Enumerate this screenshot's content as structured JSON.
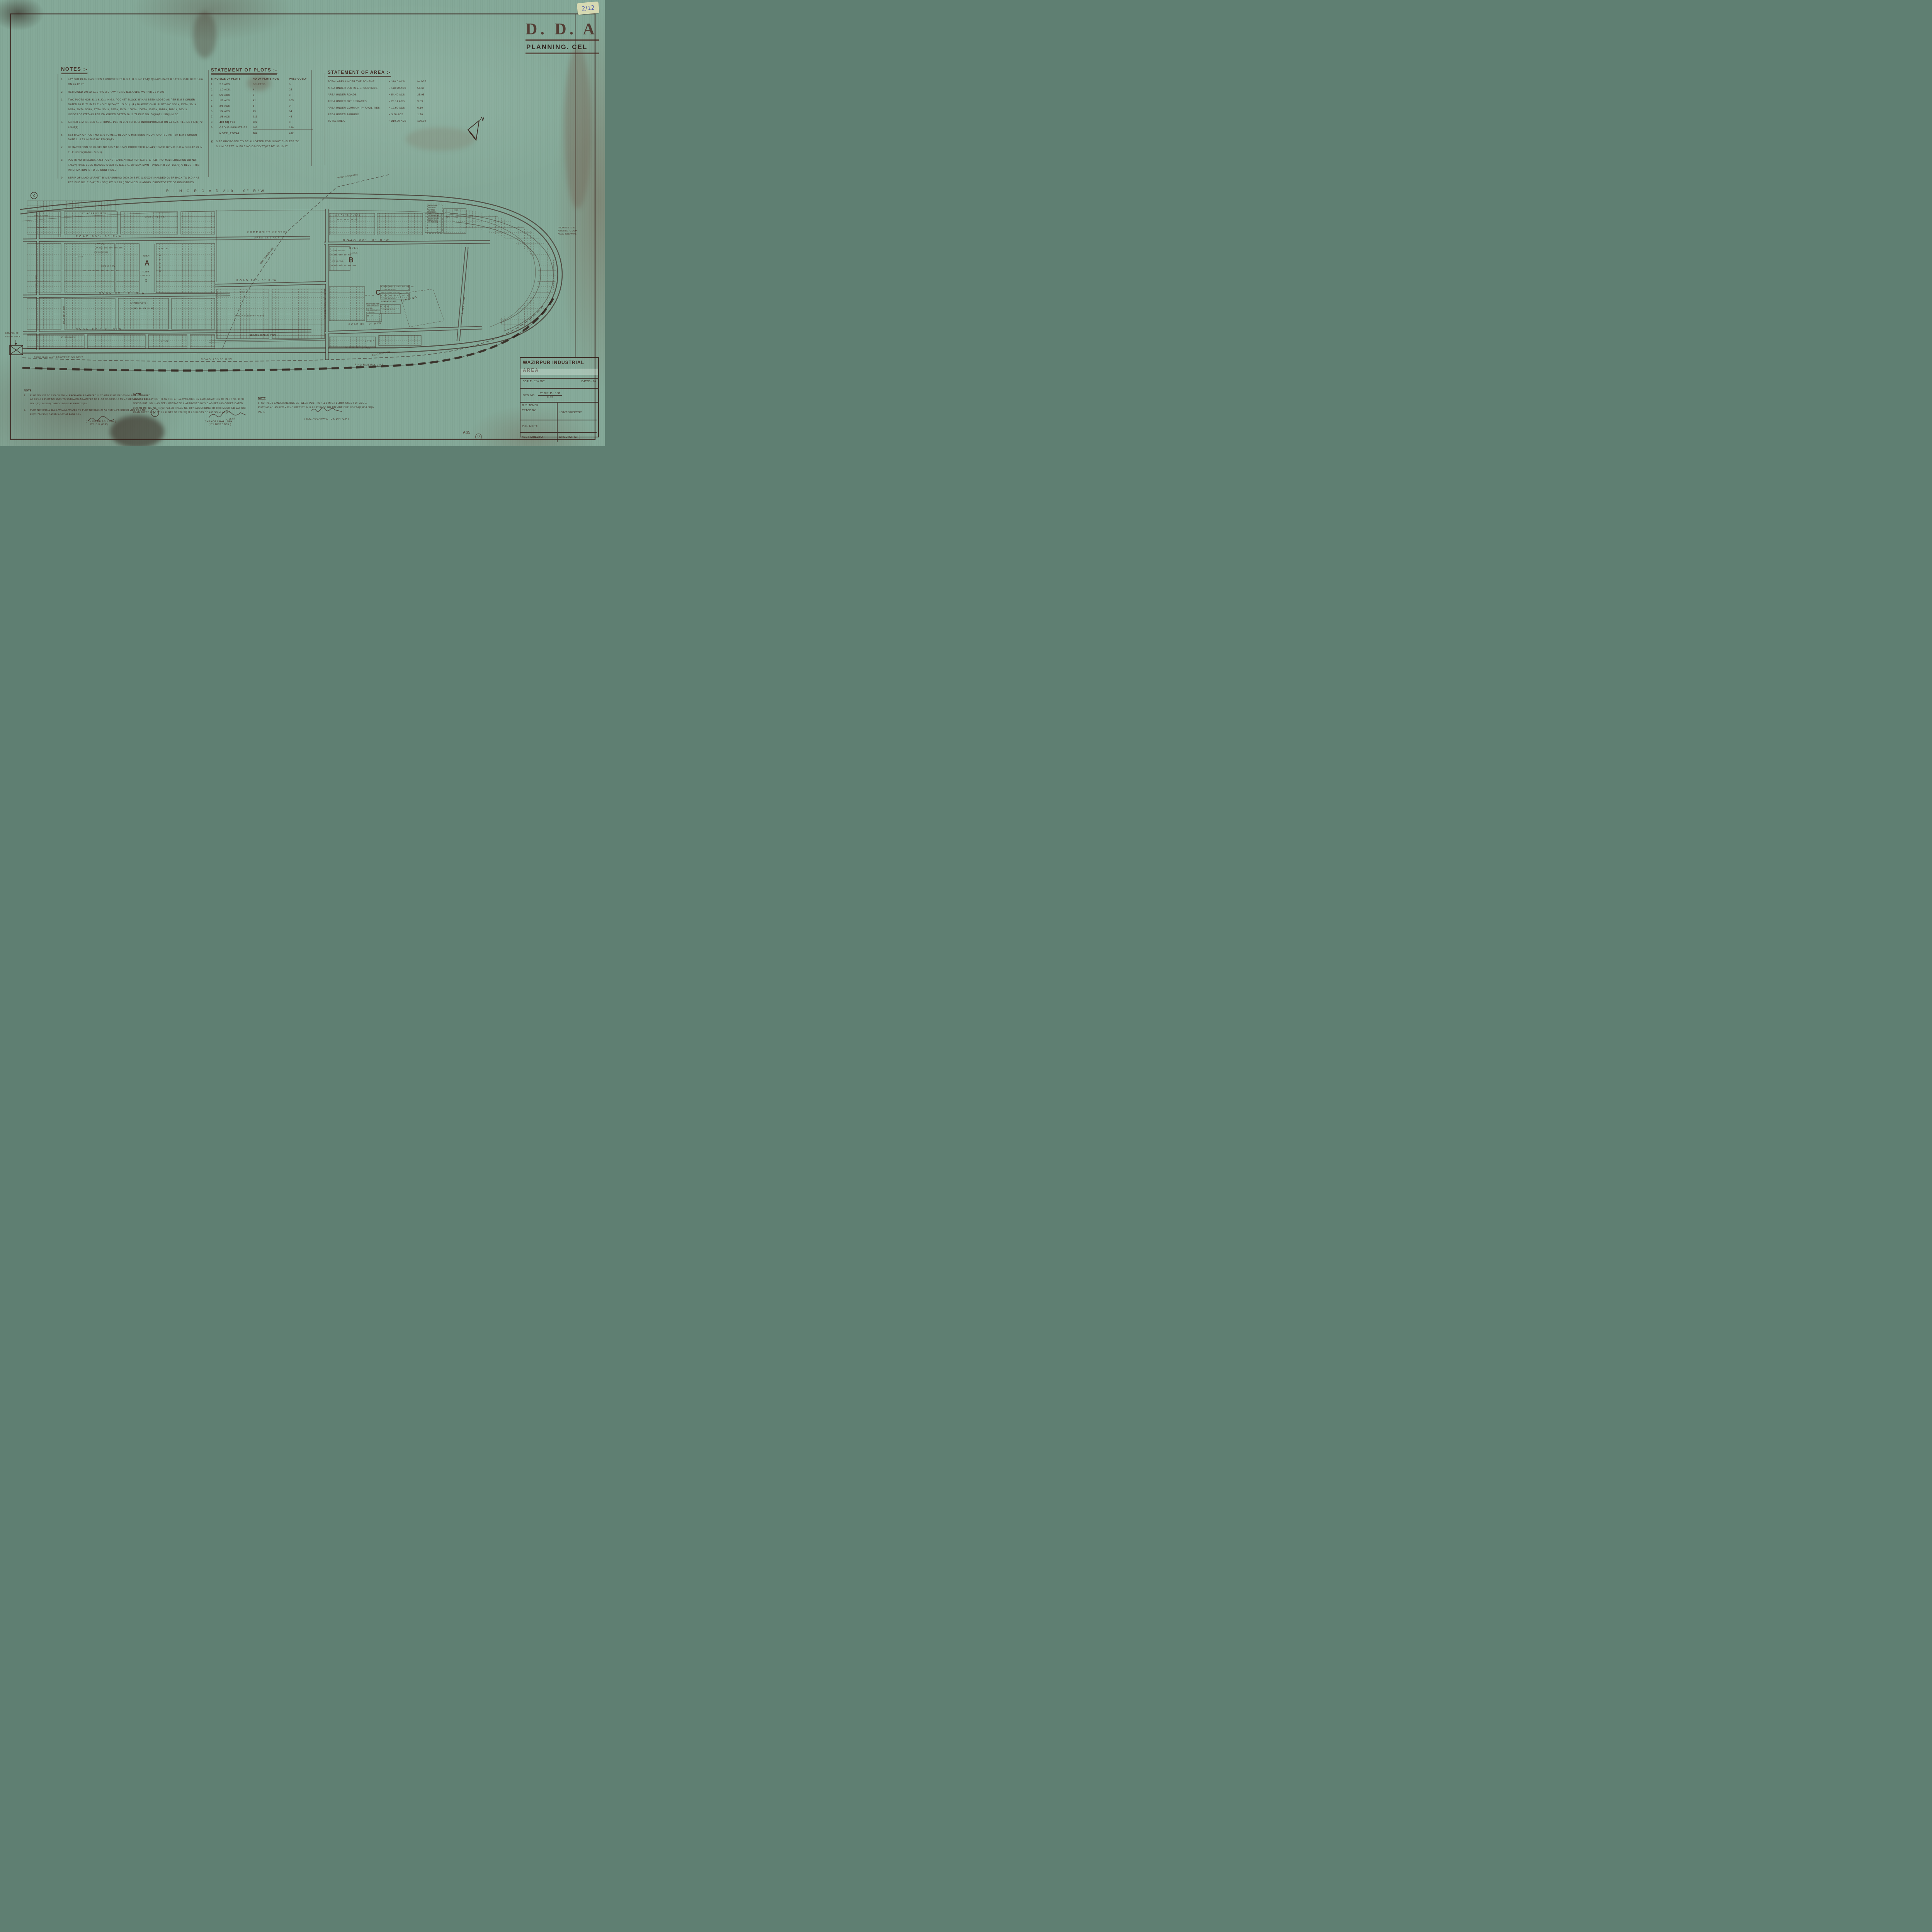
{
  "stamp": {
    "org": "D. D. A",
    "dept": "PLANNING. CEL"
  },
  "sticker": {
    "ref": "2/12"
  },
  "annotations": {
    "sheet_no": "605",
    "corner_mark": "B"
  },
  "notes": {
    "title": "NOTES :-",
    "items": [
      {
        "no": "1.",
        "text": "LAY OUT PLAN HAS BEEN APPROVED BY D.D.A, U.D. NO F14(32)61-WD PART II DATED 15TH DEC, 1967 ON 26.12.67."
      },
      {
        "no": "2",
        "text": "RETRACED ON 22.6.71 FROM DRAWING NO D.D.A/1167  WZRP(I)-7 / P-508"
      },
      {
        "no": "3.",
        "text": "TWO PLOTS NOS 31/1 & 32/1 IN G.I. POCKET BLOCK 'B' HAS BEEN ADDED AS PER E.M'S ORDER DATED 20.11.71 IN FILE NO F12(204)67 L.S.B(1). (4.) 16 ADDITIONAL PLOTS NO 95/1a, 95/2a, 96/1a, 96/2a, 96/7a, 96/8a, 97/1a, 98/1a, 99/1a, 99/2a, 100/1a, 100/2a, 101/1a, 101/8a, 102/1a, 103/1a INCORPORATED AS PER EM ORDER DATED 26.12.71 FILE NO. F6(40)71 LSB(I) MISC."
      },
      {
        "no": "5.",
        "text": "AS PER E.M. ORDER ADDITIONAL PLOTS 91/1 TO 91/10 INCORPORATED ON 24.7.72. FILE NO F6(33)72 L.S.B(1)"
      },
      {
        "no": "6.",
        "text": "SET BACK OF PLOT NO 91/1 TO 91/10 BLOCK-C HAS BEEN INCORPORATED AS PER E.M'S ORDER DATE 11.9.73 IN FILE NO F29(45)73."
      },
      {
        "no": "7.",
        "text": "DEMARCATION OF PLOTS NO 103/7 TO 104/9 CORRECTED AS APPROVED BY V.C. D.D.A ON 8.12.73 IN FILE NO F6(90)70 L.S.B(1)."
      },
      {
        "no": "8.",
        "text": "PLOTS NO 28 BLOCK-A G.I POCKET EARMARKED FOR E.S.S. & PLOT NO. 90/2 (LOCATION DO NOT TALLY) HAVE BEEN HANDED OVER TO D.E.S.U. BY DEV. DIVN II (VIDE P-II CO F29(77)75 BLDG. THIS INFORMATION IS TO BE CONFIRMED"
      },
      {
        "no": "9",
        "text": "STRIP OF LAND MARKET 'B' MEASURING 2600.00 S.FT. (130'X20') HANDED OVER BACK TO D.D.A AS PER FILE NO. F15(41)72-LSB(I) DT. 3.6.78 ( FROM DELHI ADMIS. DIRECTORATE OF INDUSTRIES."
      }
    ]
  },
  "statement_of_plots": {
    "title": "STATEMENT OF PLOTS :-",
    "headers": {
      "sno": "S. NO",
      "size": "SIZE OF PLOTS",
      "now": "NO OF PLOTS NOW",
      "prev": "PREVIOUSLY"
    },
    "rows": [
      {
        "sno": "1",
        "size": "2.0 ACS.",
        "now": "DELETED",
        "prev": "6"
      },
      {
        "sno": "2.",
        "size": "1.0 ACS.",
        "now": "4",
        "prev": "25"
      },
      {
        "sno": "3.",
        "size": "5/8 ACS",
        "now": "6",
        "prev": "0"
      },
      {
        "sno": "4.",
        "size": "1/2 ACS",
        "now": "42",
        "prev": "105"
      },
      {
        "sno": "5.",
        "size": "3/8 ACS",
        "now": "3",
        "prev": "0"
      },
      {
        "sno": "6.",
        "size": "1/4 ACS",
        "now": "99",
        "prev": "64"
      },
      {
        "sno": "7.",
        "size": "1/8 ACS",
        "now": "213",
        "prev": "45"
      },
      {
        "sno": "8",
        "size": "400 SQ YDS",
        "now": "229",
        "prev": "0"
      },
      {
        "sno": "9",
        "size": "GROUP INDUSTRIES",
        "now": "189",
        "prev": "186"
      }
    ],
    "total_label": "NOTE_TOTAL",
    "total_now": "784",
    "total_prev": "432",
    "footnote_mark": "X",
    "footnote": "SITE PROPOSED TO BE ALLOTTED FOR NIGHT SHELTER TO SLUM DEPTT. IN FILE NO DA/DD(TT)/87 DT. 30.10.87"
  },
  "statement_of_area": {
    "title": "STATEMENT OF AREA :-",
    "rows": [
      {
        "label": "TOTAL AREA UNDER THE SCHEME",
        "value": "= 210.0 ACS.",
        "pct": "% AGE"
      },
      {
        "label": "AREA UNDER PLOTS & GROUP INDS.",
        "value": "= 118.99 ACS",
        "pct": "56.66"
      },
      {
        "label": "AREA UNDER ROADS",
        "value": "= 54.40 ACS",
        "pct": "25.95"
      },
      {
        "label": "AREA UNDER OPEN SPACES",
        "value": "= 20.11 ACS",
        "pct": "9.59"
      },
      {
        "label": "AREA UNDER COMMUNITY FACILITIES",
        "value": "= 12.90 ACS",
        "pct": "6.10"
      },
      {
        "label": "AREA UNDER PARKING",
        "value": "= 3.60 ACS",
        "pct": "1.70"
      },
      {
        "label": "TOTAL AREA",
        "value": "= 210.00 ACS",
        "pct": "100.00"
      }
    ]
  },
  "map": {
    "ring_road": "R I N G   R O A D   210'- 0\"   R/W",
    "high_tension": "HIGH TENSION LINE",
    "community_centre_1": "COMMUNITY CENTRE",
    "community_centre_2": "AREA 12.9 ACS.",
    "block_a": "A",
    "block_b": "B",
    "block_c": "C",
    "open": "OPEN",
    "open_21": "2.1 ACS.",
    "open_144": "1.44 ACS",
    "dim_1074": "107.4 M.",
    "dim_6150": "61.50 M",
    "a_1000": "A 1000 SQ M",
    "x_mark": "X",
    "road_80": "ROAD  80'- 0\"  R/W",
    "road_60": "ROAD  60'- 0\"  R/W",
    "road_45": "ROAD 45'-0\" R/W",
    "road_40": "ROAD 40'-0\" R/W",
    "road_30": "ROAD 30'-0\" R/W",
    "service_road": "SERVICE ROAD 45'-0\" R/W",
    "service_lane": "SERVICE LANE 20'-0\" WD.",
    "s_lane": "S. LANE 20'-0\" WD",
    "wd_road_45": "45'-0\" WD ROAD",
    "half_acre": "1/2 ACRE PLOTS",
    "quarter_acre": "1/4 ACRE PLOTS",
    "eighth_acre": "1/8 ACRE PLOTS",
    "acre_plots": "ACRE PLOTS",
    "sq_yds_400": "400 SQ YDS.",
    "sq_yds_450": "450 SQ YDS",
    "group_ind": "GROUP INDUSTRY PLOTS",
    "parking": "PARKING",
    "rail_belt": "RING RAILWAY PROTECTION BELT",
    "rail_line": "RING RAILWAY LINE",
    "latrine_1": "LOCATION OF",
    "latrine_2": "LATRINE BLOCK",
    "maha": [
      "PROPOSED TO BE",
      "ALLOTTED TO MAHA",
      "NIGAM TELEPHONE"
    ],
    "flatted": [
      "PROPOSED",
      "SITE FOR",
      "FLATTED",
      "FACTORY",
      "AREA=1.39 AC",
      "ALLOTTED TO",
      "DIRECTOR OF",
      "IND IN FILE",
      "NO F.10(5)76"
    ],
    "anti": [
      "PROPOSED FOR",
      "ANTI RAVARAYA",
      "2.5 ACS.",
      "M.C.D IN FILE NO",
      "F.23(72)/88"
    ],
    "north": "N",
    "strips": {
      "s1": [
        "92",
        "93",
        "95",
        "97",
        "99",
        "100"
      ],
      "s21": [
        "21",
        "21/1",
        "21/2",
        "22",
        "22/1"
      ],
      "s29": [
        "29",
        "29/1",
        "29/2",
        "30",
        "30/1",
        "30/2"
      ],
      "s33": [
        "33",
        "34",
        "35"
      ],
      "s36": [
        "36",
        "36/1",
        "36/2",
        "37",
        "37/1",
        "37/2",
        "38",
        "38/1"
      ],
      "s39": [
        "39",
        "39/1",
        "39/2",
        "40",
        "40/1",
        "40/2",
        "40/3"
      ],
      "s43": [
        "43",
        "44",
        "45"
      ],
      "s46": [
        "46",
        "47"
      ],
      "s49": [
        "49",
        "49/1",
        "50"
      ],
      "s50": [
        "50",
        "51",
        "52",
        "53"
      ],
      "s51": [
        "51",
        "52",
        "53",
        "54",
        "55"
      ],
      "s81": [
        "81",
        "81/1",
        "82",
        "82/1",
        "83",
        "83/1"
      ],
      "s84": [
        "85/2",
        "85/3",
        "86",
        "86/1",
        "86/2",
        "84/1",
        "84/2",
        "84/3"
      ],
      "s87": [
        "87",
        "87/1",
        "87/2",
        "87/3",
        "87/4",
        "87/5"
      ],
      "s72": [
        "72/4",
        "72/3",
        "72/2"
      ],
      "plot725": "72/5",
      "ac10": "1.0 AC"
    }
  },
  "bottom_notes": {
    "left": {
      "heading": "NOTE",
      "items": [
        {
          "no": "1.",
          "text": "PLOT NO 93/1 TO 93/5 OF 200 M² EACH AMALAGAMATED IN TO ONE PLOT OF 1000 M² & RENUMBERED AS 93/1-5 & PLOT NO 93/15 TO 93/18 AMALAGAMATED TO PLOT NO 93/15-18 AS V.C ORDER VIDE FILL NO 1(33)79-LSB(I) DATED 21-9-82 AT PAGE 25(N)."
        },
        {
          "no": "2.",
          "text": "PLOT NO 93/25 & 93/26 AMALAGAMATED TO PLOT NO 93/25-26 AS PER V.C'S ORDER VIDE FILE NO F1(33)79-LSB(I) DATED 5-5-82 AT PAGE 90 N."
        }
      ],
      "signature": "( CHANDER BALLABH )",
      "signature_title": "DY. DIR (C.P)"
    },
    "middle": {
      "heading": "NOTE",
      "text": "A MODIFIED LAY OUT PLAN FOR AREA AVAILABLE BY AMALGAMATION OF PLOT No. 93-94 WAZIR-PUR IND. HAS BEEN PREPARED & APPROVED BY V.C AS PER HIS ORDER DATED 20/X/81 IN FILE No. F1(33)79/LSB I PAGE No. 18/N ACCORDING TO THIS MODIFIED LAY OUT PLAN THERE WILL BE 26 PLOTS OF 200 SQ M & 9 PLOTS OF 400 SQ M. AT (X)",
      "signature_date": "4.11.81",
      "signature": "CHANDRA BALLABH",
      "signature_title": "( DY DIRECTOR )"
    },
    "right": {
      "heading": "NOTE",
      "text": "1. SURPLUS LAND AVAILABLE BETWEEN PLOT NO 4 & 5 IN G.I BLOCK USED FOR ADDL. PLOT NO 4/1 AS PER V.C's ORDER DT. 6.12.86 AT PAGE NO 1/N VIDE FILE NO F6A(6)85-LSB(I) PT. II.",
      "signature": "( N.K. AGGARWAL - DY. DIR. C.P )"
    }
  },
  "title_block": {
    "title_line1": "WAZIRPUR  INDUSTRIAL",
    "title_line2": "AREA",
    "scale_label": "SCALE -",
    "scale_value": "1\" = 200'",
    "dated_label": "DATED - 76",
    "drg_label": "DRG.  NO.",
    "drg_value_top": "JT. DIR. P-II 1/91",
    "drg_value_bottom": "H-15",
    "traced_name": "B. S. TOMER.",
    "traced_label": "TRACE  BY",
    "joint_director": "JOINT DIRECTOR",
    "plg_asstt": "PLG.   ASSTT.",
    "asst_director": "ASST. DIRECTOR",
    "director": "DIRECTOR (C.P)"
  }
}
